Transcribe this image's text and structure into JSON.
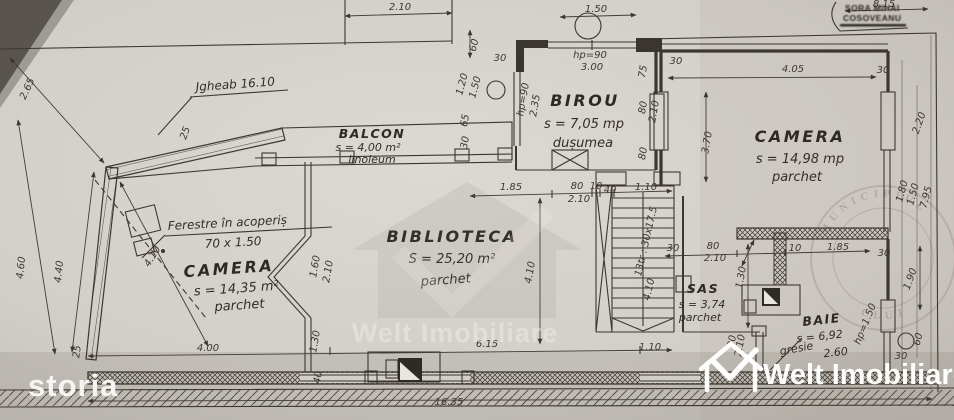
{
  "logos": {
    "storia": "storia",
    "welt_imobiliare": "Welt Imobiliare"
  },
  "watermark": {
    "text": "Welt Imobiliare"
  },
  "stamp": {
    "line1": "SORA MIHAI",
    "line2": "COSOVEANU"
  },
  "seal": {
    "arc_top": "MUNICIPIUL",
    "arc_bottom": "CLUJ"
  },
  "rooms": {
    "balcon": {
      "name": "BALCON",
      "area": "s = 4,00 m²",
      "floor": "linoleum"
    },
    "birou": {
      "name": "BIROU",
      "area": "s = 7,05 mp",
      "floor": "dușumea"
    },
    "camera_right": {
      "name": "CAMERA",
      "area": "s = 14,98 mp",
      "floor": "parchet"
    },
    "camera_left": {
      "name": "CAMERA",
      "area": "s = 14,35 m²",
      "floor": "parchet"
    },
    "biblioteca": {
      "name": "BIBLIOTECA",
      "area": "S = 25,20 m²",
      "floor": "parchet"
    },
    "sas": {
      "name": "SAS",
      "area": "s = 3,74",
      "floor": "parchet"
    },
    "baie": {
      "name": "BAIE",
      "area": "s = 6,92",
      "floor": "gresie",
      "floor2": "2.60"
    }
  },
  "annotations": {
    "ferestre_line1": "Ferestre în acoperiș",
    "ferestre_line2": "70 x 1.50",
    "jgheab": "Jgheab 16.10",
    "stairs_note": "13tr : 30x17.5"
  },
  "dimensions": [
    {
      "t": "2.10",
      "x": 400,
      "y": 10,
      "r": 0
    },
    {
      "t": "1.50",
      "x": 596,
      "y": 12,
      "r": 0
    },
    {
      "t": "8.15",
      "x": 884,
      "y": 7,
      "r": 0
    },
    {
      "t": "60",
      "x": 477,
      "y": 46,
      "r": -75
    },
    {
      "t": "30",
      "x": 500,
      "y": 61,
      "r": 0
    },
    {
      "t": "hp=90",
      "x": 590,
      "y": 58,
      "r": 0
    },
    {
      "t": "3.00",
      "x": 592,
      "y": 70,
      "r": 0
    },
    {
      "t": "4.05",
      "x": 793,
      "y": 72,
      "r": 0
    },
    {
      "t": "30",
      "x": 883,
      "y": 73,
      "r": 0
    },
    {
      "t": "1.20",
      "x": 465,
      "y": 85,
      "r": -75
    },
    {
      "t": "1.50",
      "x": 478,
      "y": 88,
      "r": -75
    },
    {
      "t": "65",
      "x": 468,
      "y": 121,
      "r": -80
    },
    {
      "t": "30",
      "x": 468,
      "y": 143,
      "r": -80
    },
    {
      "t": "hp=90",
      "x": 526,
      "y": 100,
      "r": -80
    },
    {
      "t": "2.35",
      "x": 538,
      "y": 106,
      "r": -80
    },
    {
      "t": "75",
      "x": 646,
      "y": 72,
      "r": -80
    },
    {
      "t": "80",
      "x": 646,
      "y": 108,
      "r": -80
    },
    {
      "t": "2.10",
      "x": 657,
      "y": 112,
      "r": -80
    },
    {
      "t": "80",
      "x": 646,
      "y": 154,
      "r": -80
    },
    {
      "t": "30",
      "x": 676,
      "y": 64,
      "r": 0
    },
    {
      "t": "3.70",
      "x": 710,
      "y": 143,
      "r": -80
    },
    {
      "t": "2.20",
      "x": 922,
      "y": 124,
      "r": -70
    },
    {
      "t": "1.80",
      "x": 905,
      "y": 192,
      "r": -75
    },
    {
      "t": "1.50",
      "x": 916,
      "y": 195,
      "r": -75
    },
    {
      "t": "7.95",
      "x": 929,
      "y": 198,
      "r": -75
    },
    {
      "t": "2.65",
      "x": 30,
      "y": 90,
      "r": -65
    },
    {
      "t": "4.60",
      "x": 24,
      "y": 268,
      "r": -84
    },
    {
      "t": "4.40",
      "x": 62,
      "y": 272,
      "r": -84
    },
    {
      "t": "25",
      "x": 188,
      "y": 134,
      "r": -70
    },
    {
      "t": "25",
      "x": 80,
      "y": 352,
      "r": -82
    },
    {
      "t": "4.10",
      "x": 155,
      "y": 258,
      "r": -58
    },
    {
      "t": "1.60",
      "x": 318,
      "y": 267,
      "r": -80
    },
    {
      "t": "2.10",
      "x": 331,
      "y": 272,
      "r": -80
    },
    {
      "t": "1.30",
      "x": 318,
      "y": 342,
      "r": -80
    },
    {
      "t": "40",
      "x": 321,
      "y": 378,
      "r": -80
    },
    {
      "t": "1.85",
      "x": 511,
      "y": 190,
      "r": 0
    },
    {
      "t": "80",
      "x": 577,
      "y": 189,
      "r": 0
    },
    {
      "t": "2.10",
      "x": 579,
      "y": 202,
      "r": 0
    },
    {
      "t": "10",
      "x": 596,
      "y": 189,
      "r": 0
    },
    {
      "t": "40",
      "x": 610,
      "y": 193,
      "r": 0
    },
    {
      "t": "1.10",
      "x": 646,
      "y": 190,
      "r": 0
    },
    {
      "t": "4.10",
      "x": 533,
      "y": 273,
      "r": -80
    },
    {
      "t": "6.15",
      "x": 487,
      "y": 347,
      "r": 0
    },
    {
      "t": "4.10",
      "x": 652,
      "y": 290,
      "r": -77
    },
    {
      "t": "30",
      "x": 673,
      "y": 251,
      "r": 0
    },
    {
      "t": "80",
      "x": 713,
      "y": 249,
      "r": 0
    },
    {
      "t": "2.10",
      "x": 715,
      "y": 261,
      "r": 0
    },
    {
      "t": "10",
      "x": 795,
      "y": 251,
      "r": 0
    },
    {
      "t": "1.85",
      "x": 838,
      "y": 250,
      "r": 0
    },
    {
      "t": "1.30",
      "x": 744,
      "y": 278,
      "r": -80
    },
    {
      "t": "80",
      "x": 735,
      "y": 342,
      "r": -80
    },
    {
      "t": "2.10",
      "x": 743,
      "y": 346,
      "r": -80
    },
    {
      "t": "30",
      "x": 884,
      "y": 256,
      "r": 0
    },
    {
      "t": "1.90",
      "x": 913,
      "y": 280,
      "r": -70
    },
    {
      "t": "hp=1.50",
      "x": 868,
      "y": 325,
      "r": -68
    },
    {
      "t": "30",
      "x": 901,
      "y": 359,
      "r": 0
    },
    {
      "t": "60",
      "x": 921,
      "y": 340,
      "r": -75
    },
    {
      "t": "4.00",
      "x": 208,
      "y": 351,
      "r": 0
    },
    {
      "t": "1.10",
      "x": 650,
      "y": 350,
      "r": 0
    },
    {
      "t": "16.35",
      "x": 449,
      "y": 405,
      "r": 0
    }
  ],
  "colors": {
    "paper": "#d4d0ca",
    "ink": "#3c372f",
    "logo_white": "#fdfdfc",
    "seal": "#9a817b"
  }
}
